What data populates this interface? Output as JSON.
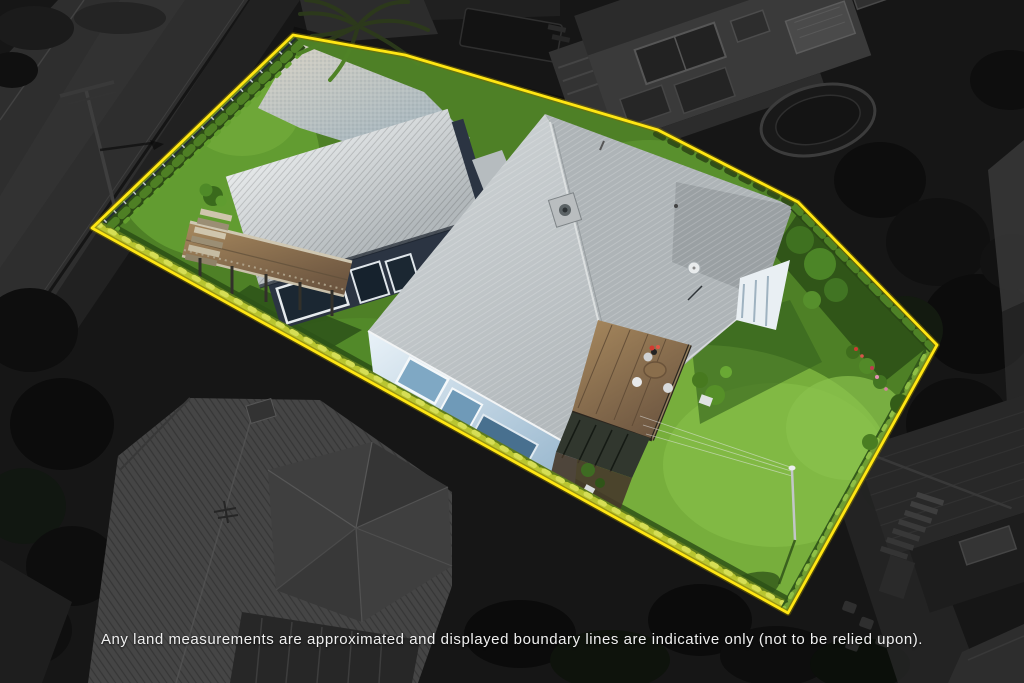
{
  "meta": {
    "kind": "real-estate aerial drone photograph",
    "treatment": "property lot shown in full colour and outlined in yellow; all surroundings darkened and desaturated"
  },
  "disclaimer": "Any land measurements are approximated and displayed boundary lines are indicative only (not to be relied upon).",
  "boundary": {
    "points": "293,35 405,55 658,130 798,202 937,345 788,613 92,228",
    "vertices": 7,
    "style": "solid"
  },
  "colors": {
    "boundary-yellow": "#ffe613",
    "surround-base": "#161616",
    "road": "#2e2e2e",
    "neighbor-roof": "#454545",
    "grass-base": "#4e8026",
    "grass-bright": "#7cb33f",
    "hedge-bright": "#b9c531",
    "foliage-dark": "#1c3110",
    "roof-light": "#dde0e1",
    "roof-main": "#b4babd",
    "wall-dark": "#2b3442",
    "wall-blue": "#cfe0ee",
    "wood-deck": "#8c7352",
    "patio": "#c6c3ba",
    "text": "#f0f0f0"
  }
}
